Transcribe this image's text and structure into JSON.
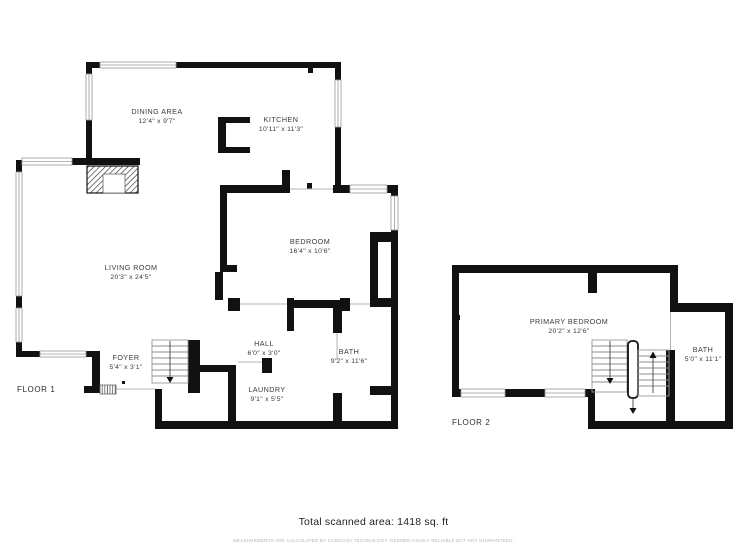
{
  "floors": [
    {
      "label": "FLOOR 1",
      "rooms": [
        {
          "name": "DINING AREA",
          "dims": "12'4\" x 9'7\""
        },
        {
          "name": "KITCHEN",
          "dims": "10'11\" x 11'3\""
        },
        {
          "name": "LIVING ROOM",
          "dims": "20'3\" x 24'5\""
        },
        {
          "name": "BEDROOM",
          "dims": "16'4\" x 10'6\""
        },
        {
          "name": "HALL",
          "dims": "6'0\" x 3'0\""
        },
        {
          "name": "BATH",
          "dims": "9'2\" x 11'6\""
        },
        {
          "name": "FOYER",
          "dims": "5'4\" x 3'1\""
        },
        {
          "name": "LAUNDRY",
          "dims": "9'1\" x 5'5\""
        }
      ]
    },
    {
      "label": "FLOOR 2",
      "rooms": [
        {
          "name": "PRIMARY BEDROOM",
          "dims": "20'2\" x 12'6\""
        },
        {
          "name": "BATH",
          "dims": "5'0\" x 11'1\""
        }
      ]
    }
  ],
  "footer": {
    "total_area": "Total scanned area: 1418 sq. ft",
    "disclaimer": "MEASUREMENTS ARE CALCULATED BY CUBICASA TECHNOLOGY. DEEMED HIGHLY RELIABLE BUT NOT GUARANTEED."
  },
  "colors": {
    "wall": "#111111",
    "background": "#ffffff",
    "label_text": "#3a3a3a",
    "window_line": "#9a9a9a",
    "disclaimer_text": "#b4b4b4"
  }
}
